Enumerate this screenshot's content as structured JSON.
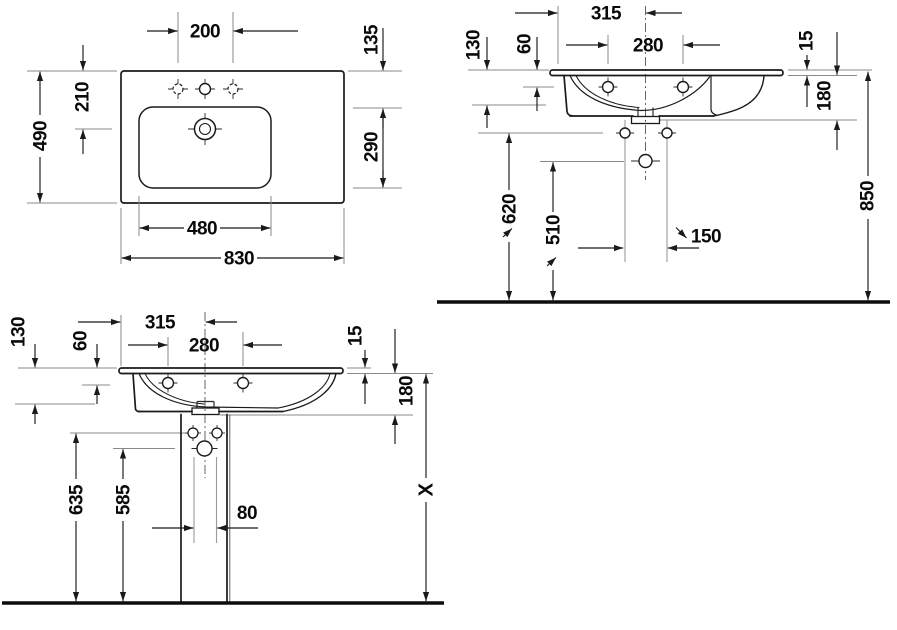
{
  "colors": {
    "line": "#1a1a1a",
    "reference_line": "#8a8a8a",
    "ground_line": "#0d0d0d",
    "text": "#0a0a0a",
    "background": "#ffffff"
  },
  "views": {
    "plan": {
      "d200": "200",
      "d135": "135",
      "d210": "210",
      "d490": "490",
      "d290": "290",
      "d480": "480",
      "d830": "830"
    },
    "wall": {
      "d315": "315",
      "d280": "280",
      "d130": "130",
      "d60": "60",
      "d15": "15",
      "d180": "180",
      "d620": "620",
      "d510": "510",
      "d150": "150",
      "d850": "850"
    },
    "pedestal": {
      "d315": "315",
      "d280": "280",
      "d130": "130",
      "d60": "60",
      "d15": "15",
      "d180": "180",
      "d635": "635",
      "d585": "585",
      "d80": "80",
      "dX": "X"
    }
  }
}
